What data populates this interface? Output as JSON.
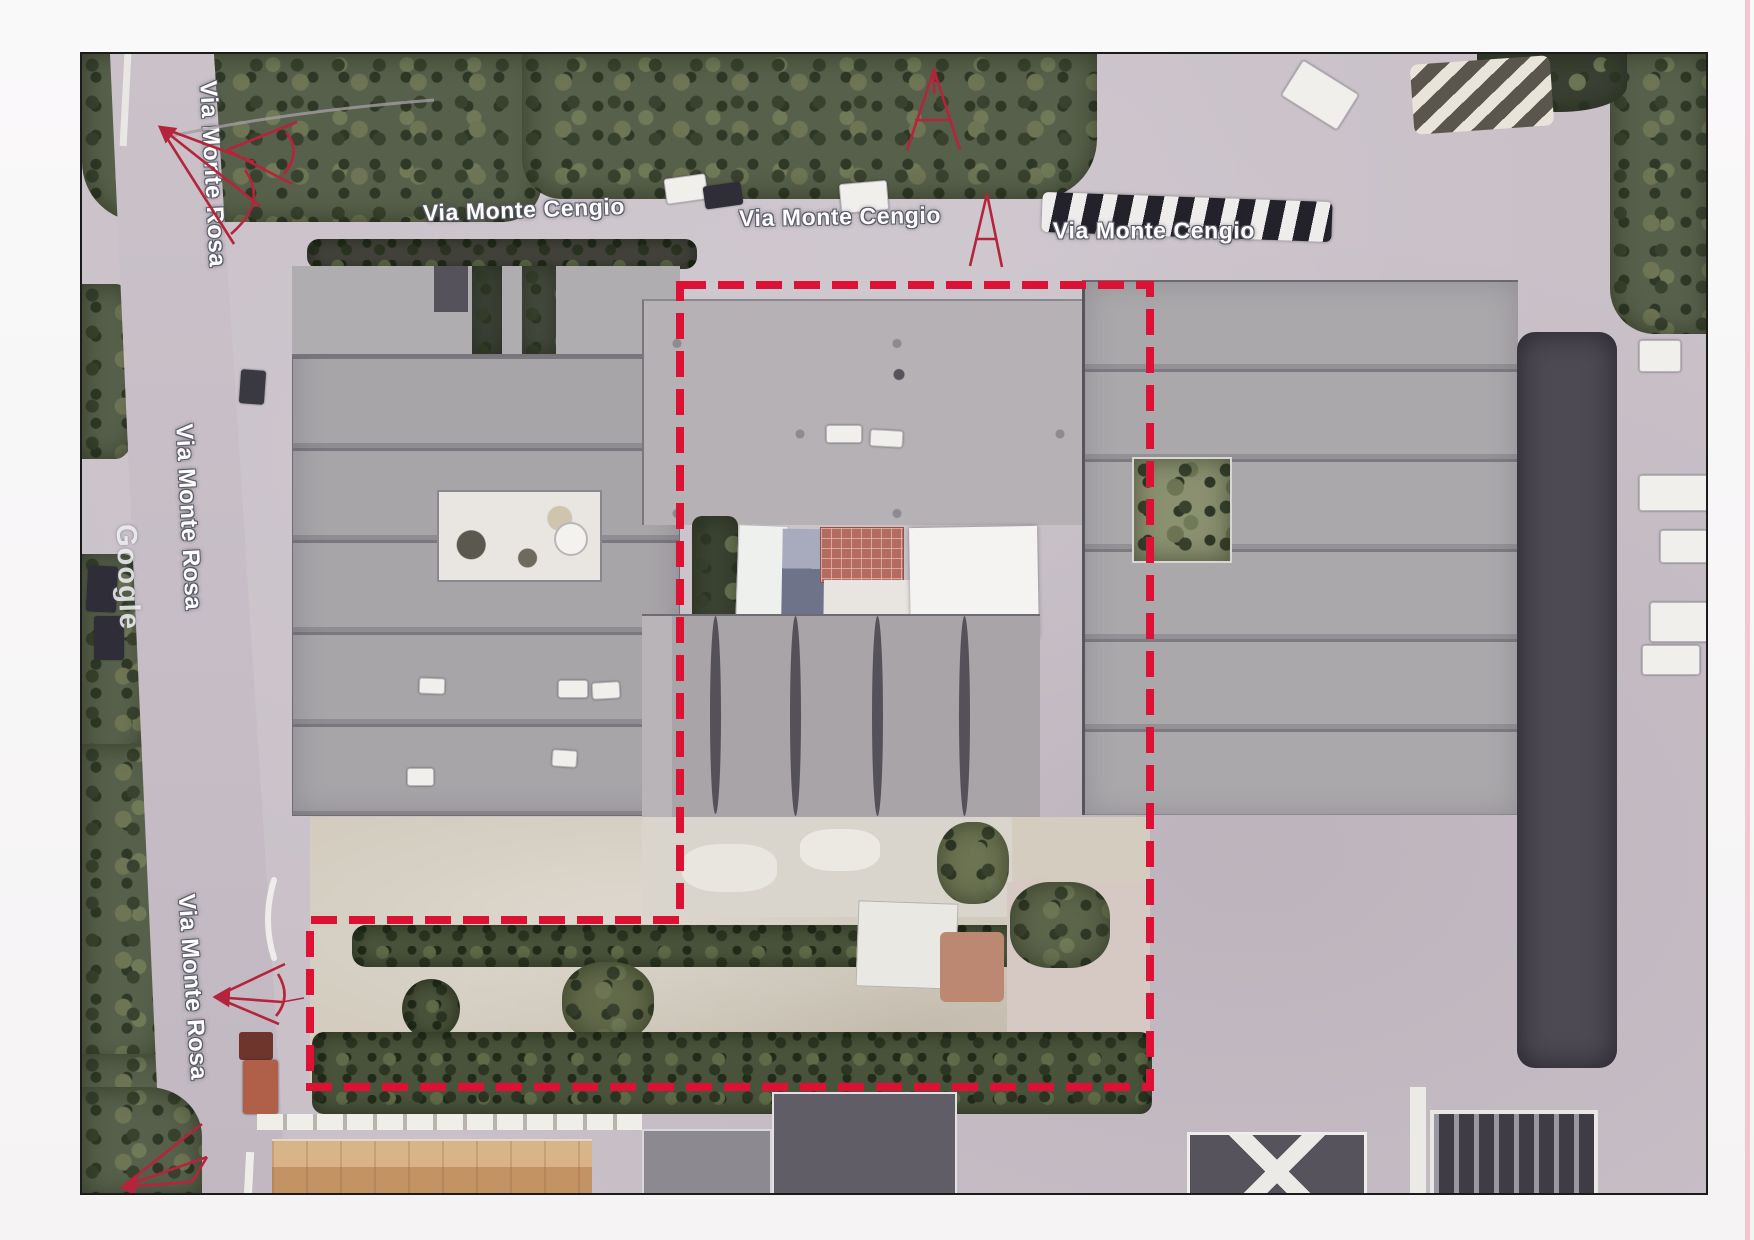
{
  "document": {
    "kind": "scanned aerial satellite photo with property boundary markup",
    "imagery_source_watermark": "Google"
  },
  "labels": {
    "street_horizontal": "Via Monte Cengio",
    "street_horizontal_instances": 3,
    "street_vertical": "Via Monte Rosa",
    "street_vertical_instances": 3,
    "watermark": "Google"
  },
  "boundary": {
    "description": "L-shaped dashed red outline around central industrial building and rear yard",
    "dash_color": "#dc1133",
    "style": "dashed"
  },
  "annotations": {
    "pen_color": "#b5243a",
    "marks": [
      "view-cone-top-left",
      "view-cone-road-top",
      "a-mark-trees-top",
      "a-mark-road-top",
      "view-cone-left-road",
      "view-arrow-bottom-left"
    ]
  },
  "colors": {
    "scan_background": "#f8f7f7",
    "scan_edge_line": "#f2bcc9",
    "pavement": "#c9c0c8",
    "trees": "#57604a",
    "roof_gray": "#a3a0a4",
    "yard_ground": "#d3ccbf",
    "panel_brick_red": "#b26b5e",
    "panel_white": "#f4f3f1",
    "orange_roof": "#c49363",
    "dark_alley": "#4e4a54"
  }
}
